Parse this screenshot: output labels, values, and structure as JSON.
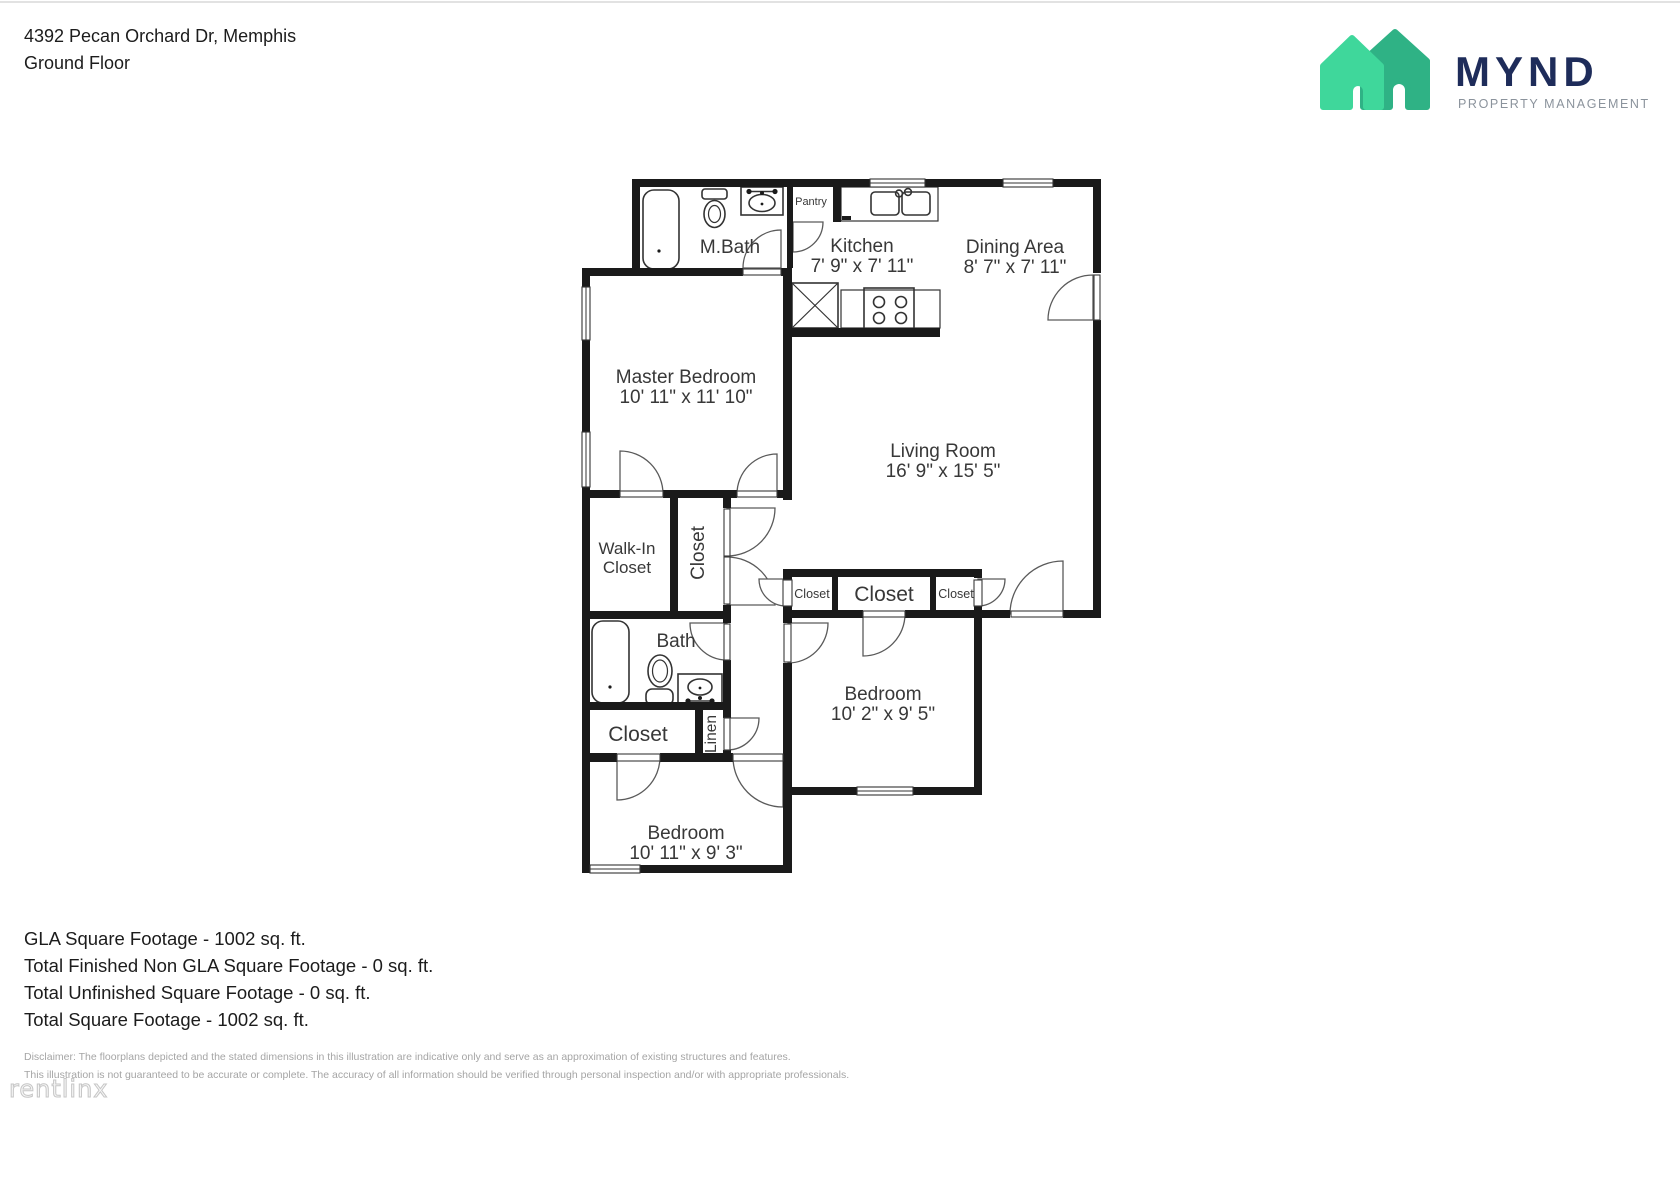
{
  "header": {
    "address": "4392 Pecan Orchard Dr, Memphis",
    "floor": "Ground Floor"
  },
  "logo": {
    "brand": "MYND",
    "tagline": "PROPERTY MANAGEMENT",
    "colors": {
      "house_light": "#3fd79b",
      "house_dark": "#2fb285",
      "brand_text": "#1e2c5a",
      "tagline_text": "#8b939c"
    }
  },
  "plan": {
    "rooms": {
      "m_bath": {
        "name": "M.Bath"
      },
      "pantry": {
        "name": "Pantry"
      },
      "kitchen": {
        "name": "Kitchen",
        "dims": "7' 9\" x 7' 11\""
      },
      "dining": {
        "name": "Dining Area",
        "dims": "8' 7\" x 7' 11\""
      },
      "master": {
        "name": "Master Bedroom",
        "dims": "10' 11\" x 11' 10\""
      },
      "living": {
        "name": "Living Room",
        "dims": "16' 9\" x 15' 5\""
      },
      "walk_in": {
        "line1": "Walk-In",
        "line2": "Closet"
      },
      "closet_hall": {
        "name": "Closet"
      },
      "closet_left_small": {
        "name": "Closet"
      },
      "closet_center": {
        "name": "Closet"
      },
      "closet_right_small": {
        "name": "Closet"
      },
      "bath": {
        "name": "Bath"
      },
      "bedroom_right": {
        "name": "Bedroom",
        "dims": "10' 2\" x 9' 5\""
      },
      "closet_bedroom": {
        "name": "Closet"
      },
      "linen": {
        "name": "Linen"
      },
      "bedroom_bottom": {
        "name": "Bedroom",
        "dims": "10' 11\" x 9' 3\""
      }
    }
  },
  "summary": {
    "lines": [
      "GLA Square Footage - 1002 sq. ft.",
      "Total Finished Non GLA Square Footage - 0 sq. ft.",
      "Total Unfinished Square Footage - 0 sq. ft.",
      "Total Square Footage - 1002 sq. ft."
    ]
  },
  "disclaimer": {
    "line1": "Disclaimer: The floorplans depicted and the stated dimensions in this illustration are indicative only and serve as an approximation of existing structures and features.",
    "line2": "This illustration is not guaranteed to be accurate or complete. The accuracy of all information should be verified through personal inspection and/or with appropriate professionals."
  },
  "watermark": {
    "text": "rentlinx"
  }
}
